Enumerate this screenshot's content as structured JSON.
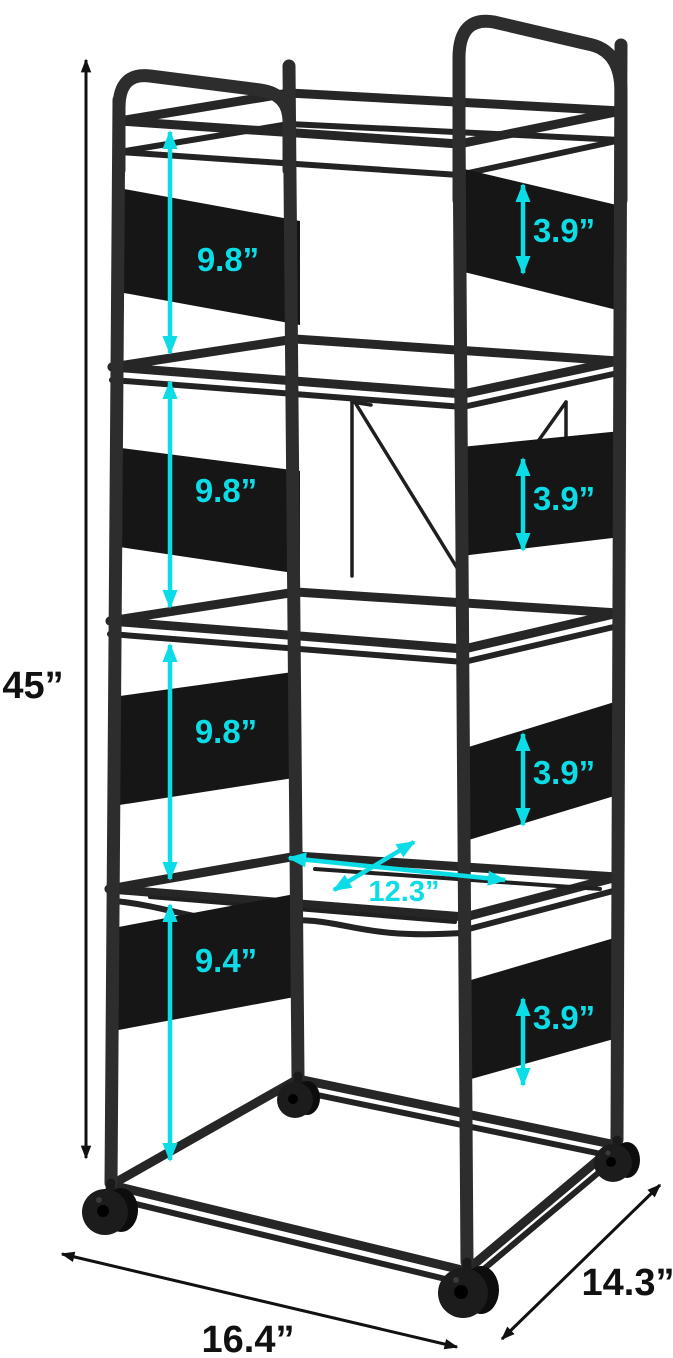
{
  "colors": {
    "accent": "#0bdce6",
    "frame": "#2d2d2d",
    "panel": "#161616",
    "ink": "#111111",
    "background": "#ffffff"
  },
  "measurements": {
    "overall_height": "45”",
    "shelf_gaps": [
      "9.8”",
      "9.8”",
      "9.8”",
      "9.4”"
    ],
    "panel_heights": [
      "3.9”",
      "3.9”",
      "3.9”",
      "3.9”"
    ],
    "inner_width": "12.3”",
    "base_width": "16.4”",
    "base_depth": "14.3”"
  }
}
